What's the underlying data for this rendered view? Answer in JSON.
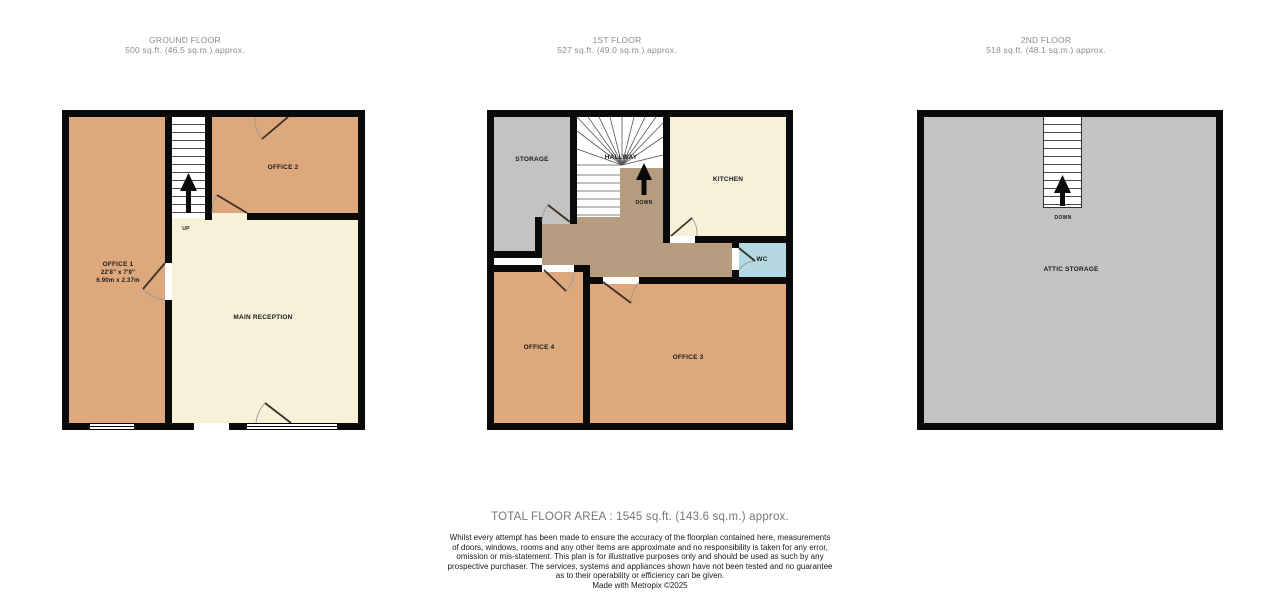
{
  "floors": [
    {
      "title": "GROUND FLOOR",
      "area": "500 sq.ft. (46.5 sq.m.) approx.",
      "rooms": {
        "office1": {
          "label": "OFFICE 1",
          "dims_ft": "22'8\" x 7'9\"",
          "dims_m": "6.90m x 2.37m"
        },
        "office2": {
          "label": "OFFICE 2"
        },
        "main_reception": {
          "label": "MAIN RECEPTION"
        }
      },
      "stairs_label": "UP"
    },
    {
      "title": "1ST FLOOR",
      "area": "527 sq.ft. (49.0 sq.m.) approx.",
      "rooms": {
        "storage": {
          "label": "STORAGE"
        },
        "hallway": {
          "label": "HALLWAY"
        },
        "kitchen": {
          "label": "KITCHEN"
        },
        "wc": {
          "label": "WC"
        },
        "office4": {
          "label": "OFFICE 4"
        },
        "office3": {
          "label": "OFFICE 3"
        }
      },
      "stairs_label": "DOWN"
    },
    {
      "title": "2ND FLOOR",
      "area": "518 sq.ft. (48.1 sq.m.) approx.",
      "rooms": {
        "attic": {
          "label": "ATTIC STORAGE"
        }
      },
      "stairs_label": "DOWN"
    }
  ],
  "footer": {
    "total": "TOTAL FLOOR AREA : 1545 sq.ft. (143.6 sq.m.) approx.",
    "disclaimer": "Whilst every attempt has been made to ensure the accuracy of the floorplan contained here, measurements\nof doors, windows, rooms and any other items are approximate and no responsibility is taken for any error,\nomission or mis-statement. This plan is for illustrative purposes only and should be used as such by any\nprospective purchaser. The services, systems and appliances shown have not been tested and no guarantee\nas to their operability or efficiency can be given.",
    "credit": "Made with Metropix ©2025"
  },
  "colors": {
    "wall": "#0a0a0a",
    "room_tan": "#dea87d",
    "room_cream": "#f7f1d8",
    "room_gray": "#c3c3c3",
    "hallway_brown": "#b69c7e",
    "wc_blue": "#b5d9e3",
    "header_text": "#8c8c8c"
  }
}
